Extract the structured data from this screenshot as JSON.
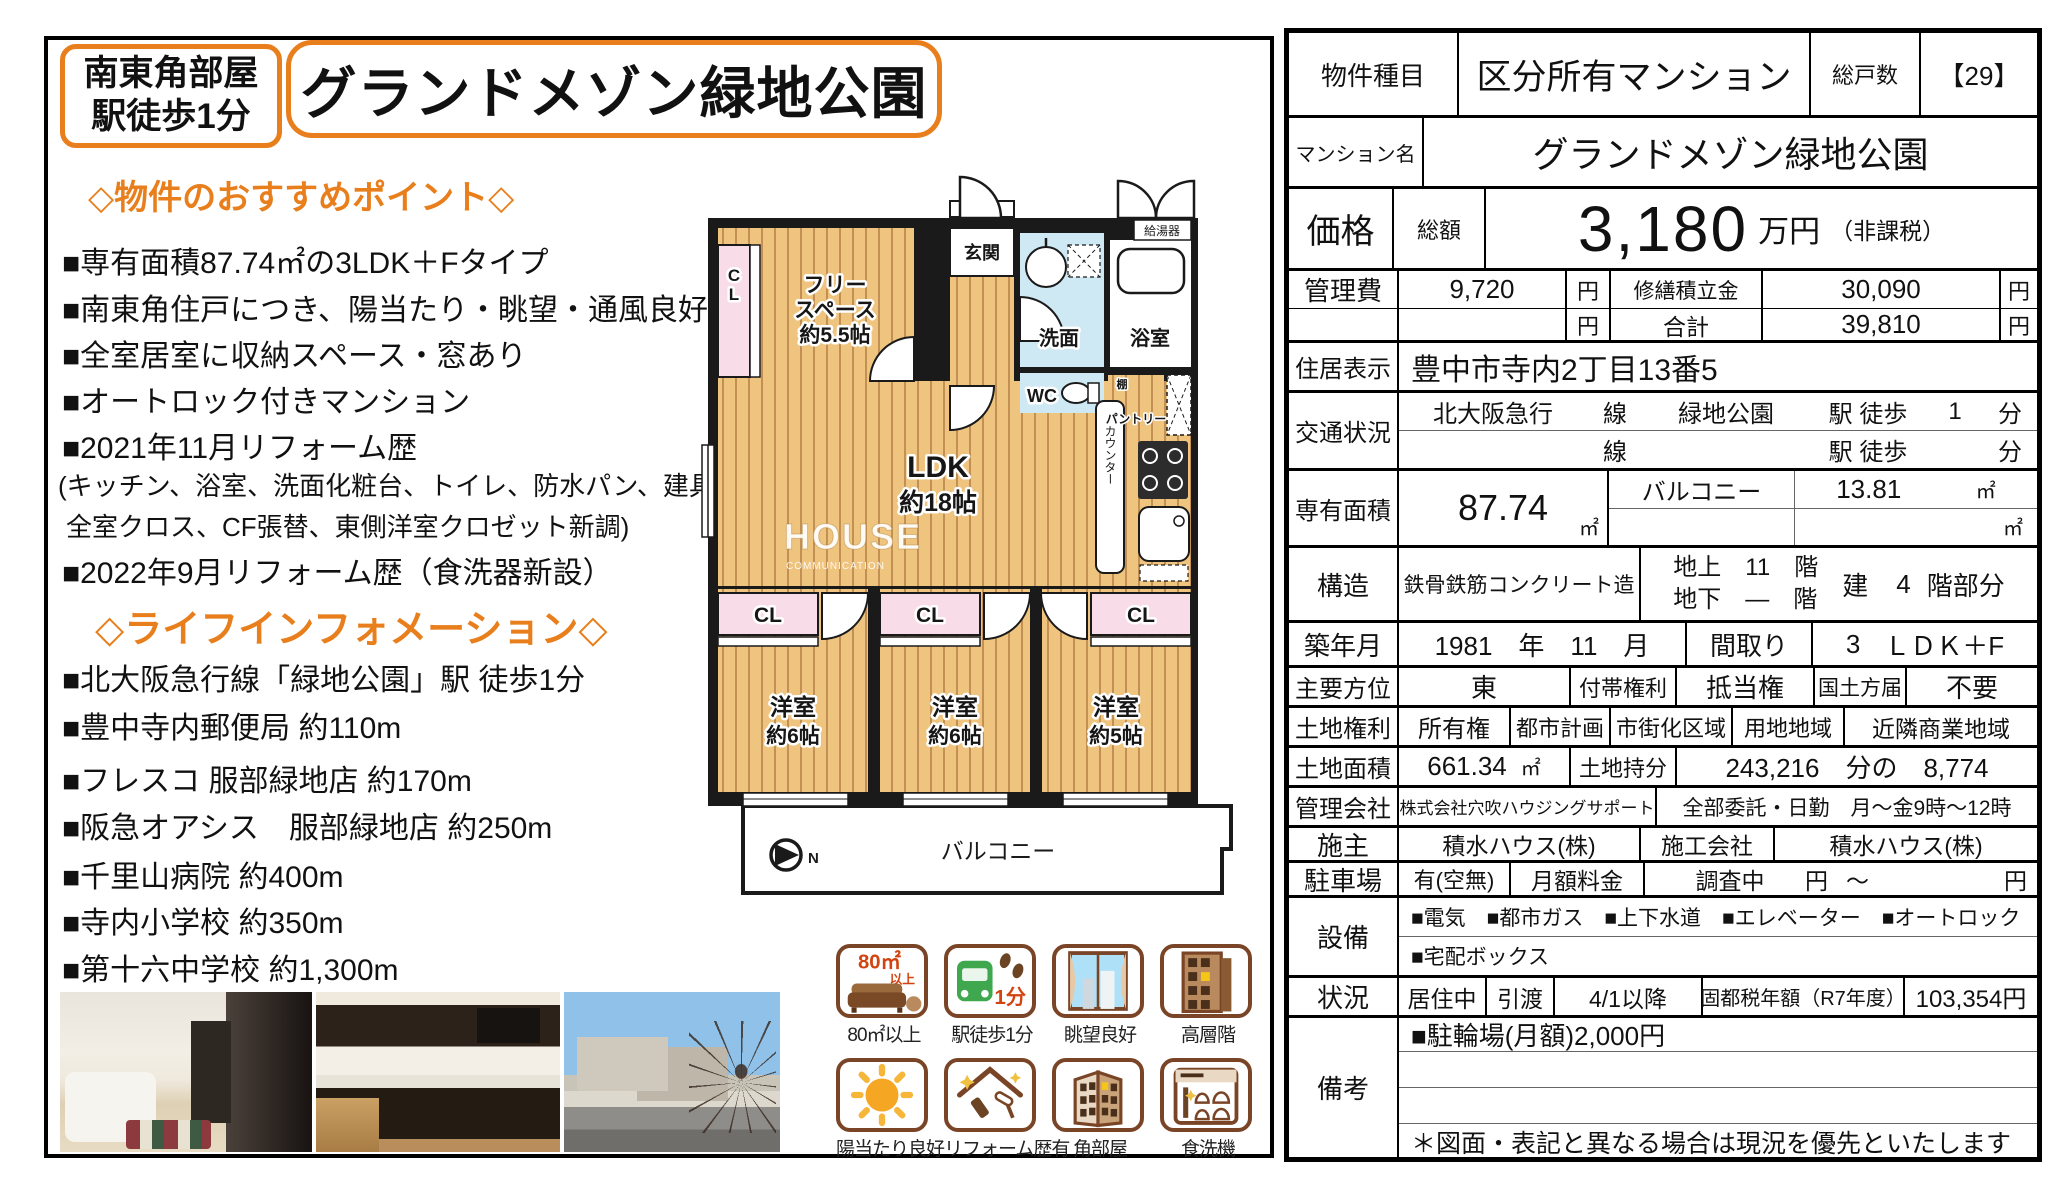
{
  "accent": "#e87f1c",
  "badge": {
    "line1": "南東角部屋",
    "line2": "駅徒歩1分"
  },
  "title": "グランドメゾン緑地公園",
  "points": {
    "heading": "◇物件のおすすめポイント◇",
    "items": [
      "■専有面積87.74㎡の3LDK＋Fタイプ",
      "■南東角住戸につき、陽当たり・眺望・通風良好",
      "■全室居室に収納スペース・窓あり",
      "■オートロック付きマンション",
      "■2021年11月リフォーム歴",
      "(キッチン、浴室、洗面化粧台、トイレ、防水パン、建具新調",
      "全室クロス、CF張替、東側洋室クロゼット新調)",
      "■2022年9月リフォーム歴（食洗器新設）"
    ]
  },
  "life": {
    "heading": "◇ライフインフォメーション◇",
    "items": [
      "■北大阪急行線「緑地公園」駅 徒歩1分",
      "■豊中寺内郵便局 約110m",
      "■フレスコ 服部緑地店 約170m",
      "■阪急オアシス　服部緑地店 約250m",
      "■千里山病院 約400m",
      "■寺内小学校 約350m",
      "■第十六中学校 約1,300m"
    ]
  },
  "plan": {
    "cl_side": "CL",
    "free1": "フリー",
    "free2": "スペース",
    "free3": "約5.5帖",
    "genkan": "玄関",
    "senmen": "洗面",
    "bath": "浴室",
    "boiler": "給湯器",
    "wc": "WC",
    "shelf": "棚",
    "pantry": "パントリー",
    "counter": "カウンター",
    "ldk1": "LDK",
    "ldk2": "約18帖",
    "wm1": "HOUSE",
    "wm2": "COMMUNICATION",
    "cl1": "CL",
    "cl2": "CL",
    "cl3": "CL",
    "room1a": "洋室",
    "room1b": "約6帖",
    "room2a": "洋室",
    "room2b": "約6帖",
    "room3a": "洋室",
    "room3b": "約5帖",
    "balcony": "バルコニー",
    "north": "N"
  },
  "features": {
    "b1": {
      "t1": "80㎡",
      "t2": "以上",
      "label": "80㎡以上"
    },
    "b2": {
      "t1": "1分",
      "label": "駅徒歩1分"
    },
    "b3": {
      "label": "眺望良好"
    },
    "b4": {
      "label": "高層階"
    },
    "b5": {
      "label": "陽当たり良好"
    },
    "b6": {
      "label": "リフォーム歴有"
    },
    "b7": {
      "label": "角部屋"
    },
    "b8": {
      "label": "食洗機"
    }
  },
  "table": {
    "r1": {
      "label": "物件種目",
      "value": "区分所有マンション",
      "units_label": "総戸数",
      "units": "【29】"
    },
    "r2": {
      "label": "マンション名",
      "value": "グランドメゾン緑地公園"
    },
    "r3": {
      "label": "価格",
      "sub": "総額",
      "value": "3,180",
      "unit": "万円",
      "note": "（非課税）"
    },
    "r4": {
      "label": "管理費",
      "v1": "9,720",
      "yen1": "円",
      "label2": "修繕積立金",
      "v2": "30,090",
      "yen2": "円"
    },
    "r5": {
      "label": "",
      "v1": "",
      "yen1": "円",
      "label2": "合計",
      "v2": "39,810",
      "yen2": "円"
    },
    "r6": {
      "label": "住居表示",
      "value": "豊中市寺内2丁目13番5"
    },
    "r7": {
      "label": "交通状況",
      "l1a": "北大阪急行",
      "l1b": "線",
      "l1c": "緑地公園",
      "l1d": "駅 徒歩",
      "l1e": "1",
      "l1f": "分",
      "l2a": "",
      "l2b": "線",
      "l2c": "",
      "l2d": "駅 徒歩",
      "l2e": "",
      "l2f": "分"
    },
    "r8": {
      "label": "専有面積",
      "value": "87.74",
      "unit": "㎡",
      "b_label": "バルコニー",
      "b_value": "13.81",
      "b_unit": "㎡",
      "b_unit2": "㎡"
    },
    "r9": {
      "label": "構造",
      "value": "鉄骨鉄筋コンクリート造",
      "f1": "地上　11　階",
      "f2": "地下　―　階",
      "b1": "建",
      "b2": "4",
      "b3": "階部分"
    },
    "r10": {
      "label": "築年月",
      "date": "1981　年　11　月",
      "label2": "間取り",
      "v2a": "3",
      "v2b": "ＬＤＫ＋F"
    },
    "r11": {
      "label": "主要方位",
      "v1": "東",
      "l2": "付帯権利",
      "v2": "抵当権",
      "l3": "国土方届",
      "v3": "不要"
    },
    "r12": {
      "label": "土地権利",
      "v1": "所有権",
      "l2": "都市計画",
      "v2": "市街化区域",
      "l3": "用地地域",
      "v3": "近隣商業地域"
    },
    "r13": {
      "label": "土地面積",
      "v1": "661.34",
      "u1": "㎡",
      "l2": "土地持分",
      "share": "243,216　分の　8,774"
    },
    "r14": {
      "label": "管理会社",
      "v1": "株式会社穴吹ハウジングサポート",
      "v2": "全部委託・日勤　月～金9時～12時"
    },
    "r15": {
      "label": "施主",
      "v1": "積水ハウス(株)",
      "l2": "施工会社",
      "v2": "積水ハウス(株)"
    },
    "r16": {
      "label": "駐車場",
      "v1": "有(空無)",
      "l2": "月額料金",
      "v2": "調査中",
      "y1": "円",
      "tilde": "～",
      "y2": "円"
    },
    "r17": {
      "label": "設備",
      "line1": "■電気　■都市ガス　■上下水道　■エレベーター　■オートロック",
      "line2": "■宅配ボックス"
    },
    "r18": {
      "label": "状況",
      "v1": "居住中",
      "l2": "引渡",
      "v2": "4/1以降",
      "l3": "固都税年額（R7年度）",
      "v3": "103,354円"
    },
    "r19": {
      "label": "備考",
      "line1": "■駐輪場(月額)2,000円",
      "line2": "",
      "line3": "",
      "note": "＊図面・表記と異なる場合は現況を優先といたします"
    }
  }
}
